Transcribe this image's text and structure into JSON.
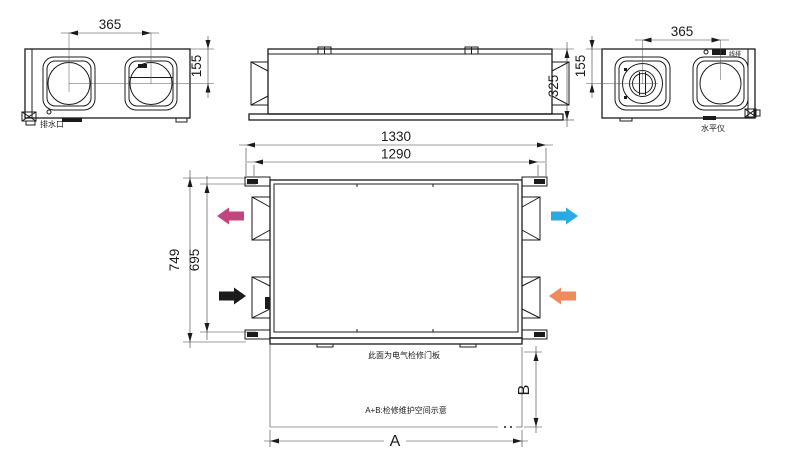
{
  "drawing": {
    "left_view": {
      "dim_port_spacing": "365",
      "dim_port_offset": "155",
      "label_drain_outlet": "排水口"
    },
    "front_view": {
      "dim_height": "325"
    },
    "right_view": {
      "dim_port_spacing": "365",
      "dim_port_offset": "155",
      "label_terminal_strip": "线排",
      "label_level_gauge": "水平仪"
    },
    "plan_view": {
      "dim_overall_length": "1330",
      "dim_mount_length": "1290",
      "dim_overall_width": "749",
      "dim_body_width": "695",
      "dim_service_width": "A",
      "dim_service_depth": "B",
      "note_access_panel": "此面为电气检修门板",
      "note_service_space": "A+B:检修维护空间示意"
    },
    "colors": {
      "line": "#1b1b1b",
      "arrow_exhaust_magenta": "#c2457e",
      "arrow_supply_blue": "#29abe2",
      "arrow_fresh_black": "#1b1b1b",
      "arrow_return_orange": "#ef8a5c"
    }
  }
}
